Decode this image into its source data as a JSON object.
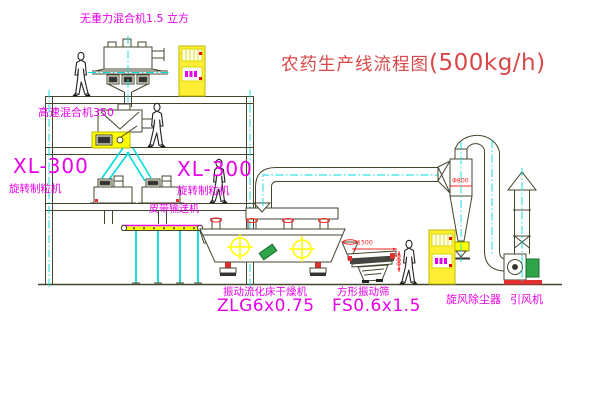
{
  "title": {
    "text": "农药生产线流程图",
    "capacity": "(500kg/h)"
  },
  "equipment_labels": {
    "weightless_mixer": "无重力混合机1.5 立方",
    "high_speed_mixer": "高速混合机350",
    "granulator_left_model": "XL-300",
    "granulator_left_name": "旋转制粒机",
    "granulator_right_model": "XL-300",
    "granulator_right_name": "旋转制粒机",
    "belt_conveyor": "皮带输送机",
    "dryer_name": "振动流化床干燥机",
    "dryer_model": "ZLG6x0.75",
    "screen_name": "方形振动筛",
    "screen_model": "FS0.6x1.5",
    "cyclone": "旋风除尘器",
    "induced_draft_fan": "引风机"
  },
  "dimensions": {
    "screen_length": "1500",
    "screen_width": "600",
    "cyclone_diameter": "Φ800"
  },
  "colors": {
    "line": "#45452e",
    "centerline": "#00dcdc",
    "label_magenta": "#e800e8",
    "title_red": "#d84848",
    "dimension_red": "#ff2020",
    "highlight_yellow": "#ffff00",
    "machine_green": "#2fa44a"
  }
}
